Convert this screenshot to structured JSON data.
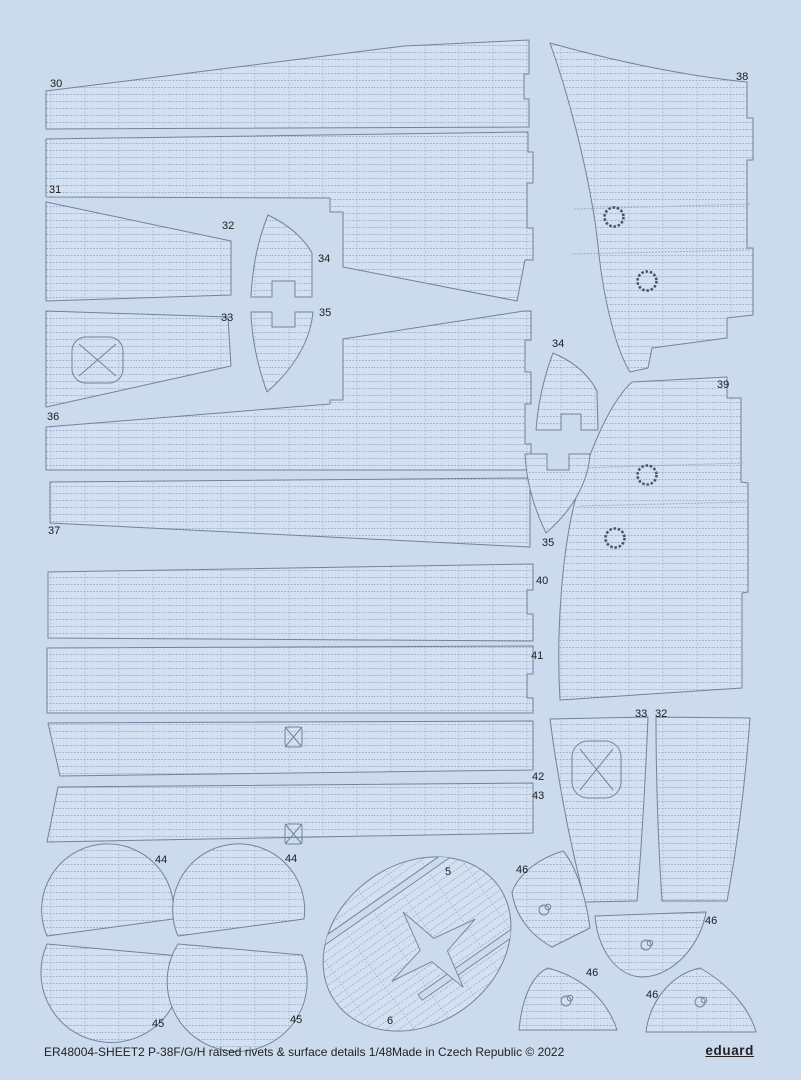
{
  "sheet": {
    "title": "ER48004-SHEET2 P-38F/G/H raised rivets & surface details 1/48",
    "origin": "Made in Czech Republic © 2022",
    "brand": "eduard"
  },
  "colors": {
    "background": "#cbdaed",
    "part_fill": "#d3e0f1",
    "outline": "#73829b",
    "rivet_dot": "#9cb0c9",
    "detail_dark": "#45556c",
    "label_text": "#1c1c1e",
    "footer_text": "#222222"
  },
  "part_labels": [
    {
      "text": "30",
      "x": 50,
      "y": 87
    },
    {
      "text": "31",
      "x": 49,
      "y": 193
    },
    {
      "text": "32",
      "x": 222,
      "y": 229
    },
    {
      "text": "34",
      "x": 318,
      "y": 262
    },
    {
      "text": "33",
      "x": 221,
      "y": 321
    },
    {
      "text": "35",
      "x": 319,
      "y": 316
    },
    {
      "text": "36",
      "x": 47,
      "y": 420
    },
    {
      "text": "37",
      "x": 48,
      "y": 534
    },
    {
      "text": "38",
      "x": 736,
      "y": 80
    },
    {
      "text": "34",
      "x": 552,
      "y": 347
    },
    {
      "text": "39",
      "x": 717,
      "y": 388
    },
    {
      "text": "35",
      "x": 542,
      "y": 546
    },
    {
      "text": "40",
      "x": 536,
      "y": 584
    },
    {
      "text": "41",
      "x": 531,
      "y": 659
    },
    {
      "text": "42",
      "x": 532,
      "y": 780
    },
    {
      "text": "43",
      "x": 532,
      "y": 799
    },
    {
      "text": "33",
      "x": 635,
      "y": 717
    },
    {
      "text": "32",
      "x": 655,
      "y": 717
    },
    {
      "text": "44",
      "x": 155,
      "y": 863
    },
    {
      "text": "44",
      "x": 285,
      "y": 862
    },
    {
      "text": "5",
      "x": 445,
      "y": 875
    },
    {
      "text": "46",
      "x": 516,
      "y": 873
    },
    {
      "text": "45",
      "x": 152,
      "y": 1027
    },
    {
      "text": "45",
      "x": 290,
      "y": 1023
    },
    {
      "text": "6",
      "x": 387,
      "y": 1024
    },
    {
      "text": "46",
      "x": 705,
      "y": 924
    },
    {
      "text": "46",
      "x": 586,
      "y": 976
    },
    {
      "text": "46",
      "x": 646,
      "y": 998
    }
  ]
}
